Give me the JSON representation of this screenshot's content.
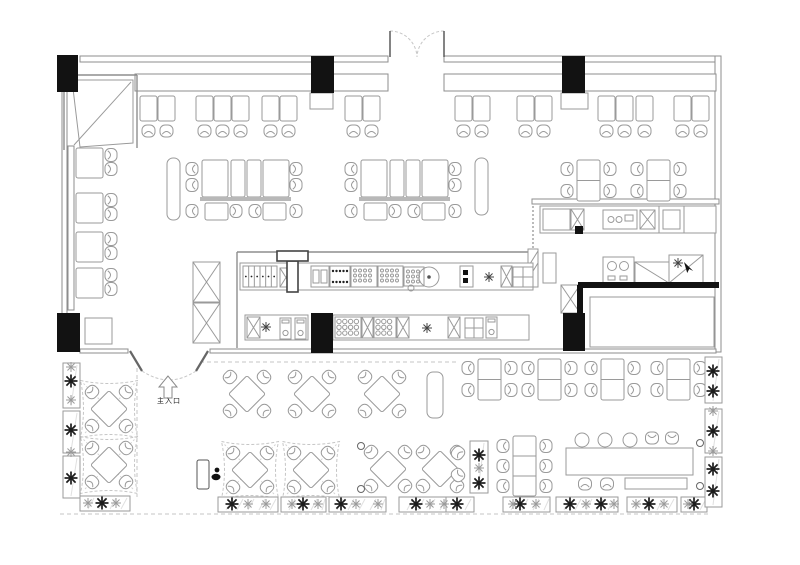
{
  "labels": {
    "entrance": "主入口"
  },
  "colors": {
    "bg": "#ffffff",
    "line": "#9a9a9a",
    "line_dark": "#5a5a5a",
    "black": "#121212",
    "light": "#c6c6c6",
    "bar": "#b8b8b8",
    "plant_dark": "#1c1c1c",
    "plant_light": "#9b9b9b"
  },
  "plan": {
    "columns": [
      [
        57,
        55,
        21,
        37
      ],
      [
        311,
        56,
        23,
        37
      ],
      [
        562,
        56,
        23,
        37
      ],
      [
        57,
        313,
        23,
        39
      ],
      [
        311,
        313,
        22,
        40
      ],
      [
        563,
        313,
        22,
        38
      ]
    ],
    "walls": {
      "rects": [
        [
          80,
          56,
          308,
          6
        ],
        [
          444,
          56,
          272,
          6
        ],
        [
          715,
          56,
          6,
          296
        ],
        [
          62,
          90,
          5,
          225
        ],
        [
          80,
          349,
          48,
          4
        ],
        [
          210,
          349,
          506,
          4
        ],
        [
          532,
          199,
          187,
          5
        ],
        [
          135,
          74,
          253,
          17
        ],
        [
          444,
          74,
          272,
          17
        ],
        [
          68,
          146,
          6,
          164
        ]
      ],
      "lines": [
        [
          237,
          252,
          533,
          252
        ],
        [
          237,
          252,
          237,
          348
        ],
        [
          64,
          150,
          64,
          75
        ],
        [
          64,
          75,
          137,
          75
        ],
        [
          137,
          75,
          137,
          148
        ]
      ],
      "thick": [
        [
          578,
          285,
          719,
          285
        ],
        [
          580,
          285,
          580,
          351
        ]
      ],
      "inner_room": [
        590,
        297,
        124,
        50
      ],
      "booth_poly": "72,80 133,80 133,143 80,147",
      "booth_diag": [
        74,
        145,
        131,
        82
      ],
      "post": [
        528,
        249,
        10,
        38
      ],
      "squiggle": [
        533,
        206,
        533,
        249
      ]
    },
    "dashed_lines": [
      [
        200,
        362,
        456,
        362
      ],
      [
        137,
        368,
        137,
        497
      ],
      [
        60,
        514,
        708,
        514
      ]
    ],
    "doors": {
      "top_arcs": [
        "M390,31 A27,27 0 0 1 417,57",
        "M444,31 A27,27 0 0 0 417,57"
      ],
      "top_leaves": [
        [
          390,
          31,
          390,
          57
        ],
        [
          444,
          31,
          444,
          57
        ]
      ],
      "ent_arcs": [
        "M142,371 Q156,380 169,380",
        "M196,371 Q182,380 169,380"
      ],
      "ent_leaves": [
        [
          130,
          351,
          142,
          371
        ],
        [
          208,
          351,
          196,
          371
        ]
      ],
      "arrow": "168,376 159,387 164,387 164,398 172,398 172,387 177,387"
    },
    "top_tables": [
      140,
      158,
      196,
      214,
      232,
      262,
      280,
      345,
      363,
      455,
      473,
      517,
      535,
      598,
      616,
      636,
      674,
      692
    ],
    "service_tables": [
      [
        310,
        93,
        23,
        16
      ],
      [
        561,
        93,
        27,
        16
      ]
    ],
    "wall_tables_y": [
      148,
      193,
      232,
      268
    ],
    "square_tables": [
      [
        85,
        318,
        27,
        26
      ]
    ],
    "clusters": [
      [
        202,
        160
      ],
      [
        361,
        160
      ]
    ],
    "benches": [
      [
        167,
        158,
        13,
        62
      ],
      [
        475,
        158,
        13,
        57
      ],
      [
        427,
        372,
        16,
        46
      ]
    ],
    "four_seat": [
      [
        577,
        160
      ],
      [
        647,
        160
      ],
      [
        478,
        359
      ],
      [
        538,
        359
      ],
      [
        601,
        359
      ],
      [
        667,
        359
      ]
    ],
    "six_seat": [
      [
        513,
        436
      ]
    ],
    "diamonds": [
      [
        247,
        394
      ],
      [
        312,
        394
      ],
      [
        382,
        394
      ],
      [
        388,
        469
      ],
      [
        440,
        469
      ]
    ],
    "canopies": [
      [
        109,
        409
      ],
      [
        109,
        465
      ],
      [
        250,
        470
      ],
      [
        311,
        470
      ]
    ],
    "long_table": {
      "table": [
        566,
        448,
        127,
        27
      ],
      "stools": [
        [
          582,
          440
        ],
        [
          605,
          440
        ],
        [
          630,
          440
        ]
      ],
      "chairs": [
        [
          652,
          438
        ],
        [
          672,
          438
        ]
      ],
      "stools2": [
        [
          578,
          477
        ],
        [
          600,
          477
        ]
      ],
      "bench": [
        625,
        478,
        62,
        11
      ]
    },
    "corner_chairs": [
      [
        458,
        453,
        -50
      ],
      [
        458,
        475,
        -130
      ]
    ],
    "lights": [
      [
        361,
        446
      ],
      [
        361,
        489
      ],
      [
        700,
        443
      ],
      [
        700,
        486
      ]
    ],
    "sign": [
      197,
      460,
      12,
      29
    ],
    "person": [
      216,
      470
    ],
    "cursor": [
      684,
      262
    ],
    "tduct": [
      277,
      251,
      31,
      41
    ],
    "kitchen": [
      [
        "plain",
        240,
        263,
        293,
        27
      ],
      [
        "compartments",
        243,
        266,
        34,
        21
      ],
      [
        "xbox",
        280,
        268,
        12,
        19
      ],
      [
        "sink2",
        311,
        266,
        18,
        21
      ],
      [
        "burners",
        330,
        266,
        20,
        21
      ],
      [
        "circgrid",
        351,
        266,
        26,
        21
      ],
      [
        "circgrid",
        378,
        266,
        25,
        21
      ],
      [
        "circgrid",
        404,
        267,
        20,
        19
      ],
      [
        "circ",
        411,
        288,
        3,
        0
      ],
      [
        "bigcirc",
        429,
        277,
        10,
        0
      ],
      [
        "blackpair",
        460,
        266,
        13,
        21
      ],
      [
        "drain",
        489,
        277,
        0,
        0
      ],
      [
        "xbox",
        501,
        266,
        11,
        21
      ],
      [
        "grid2x2",
        513,
        267,
        20,
        20
      ],
      [
        "plain",
        245,
        315,
        63,
        25
      ],
      [
        "xbox",
        247,
        317,
        13,
        21
      ],
      [
        "drain",
        266,
        327,
        0,
        0
      ],
      [
        "bottle",
        280,
        318,
        11,
        21
      ],
      [
        "bottle",
        295,
        318,
        11,
        21
      ],
      [
        "plain",
        333,
        315,
        196,
        25
      ],
      [
        "griddle",
        335,
        317,
        26,
        21
      ],
      [
        "xbox",
        362,
        317,
        11,
        21
      ],
      [
        "griddle",
        374,
        317,
        22,
        21
      ],
      [
        "xbox",
        397,
        317,
        12,
        21
      ],
      [
        "drain",
        427,
        328,
        0,
        0
      ],
      [
        "xbox",
        448,
        317,
        12,
        21
      ],
      [
        "grid2x2",
        465,
        318,
        18,
        20
      ],
      [
        "bottle",
        486,
        317,
        11,
        21
      ],
      [
        "plain",
        540,
        206,
        176,
        27
      ],
      [
        "plain",
        543,
        209,
        27,
        21
      ],
      [
        "xbox",
        571,
        209,
        13,
        21
      ],
      [
        "blacksq",
        575,
        226,
        8,
        8
      ],
      [
        "sinkoval",
        603,
        210,
        34,
        19
      ],
      [
        "xbox",
        640,
        210,
        15,
        19
      ],
      [
        "hood",
        659,
        206,
        25,
        27
      ],
      [
        "plain",
        543,
        253,
        13,
        30
      ],
      [
        "xbox",
        561,
        285,
        19,
        28
      ],
      [
        "sinkfaucet",
        603,
        257,
        31,
        26
      ],
      [
        "diag",
        635,
        262,
        34,
        21
      ],
      [
        "asterdiag",
        669,
        255,
        34,
        28
      ],
      [
        "xbox",
        193,
        262,
        27,
        40
      ],
      [
        "xbox",
        193,
        303,
        27,
        40
      ]
    ],
    "planters": [
      [
        63,
        363,
        17,
        45
      ],
      [
        63,
        411,
        17,
        42
      ],
      [
        63,
        456,
        17,
        42
      ],
      [
        80,
        496,
        50,
        15
      ],
      [
        218,
        497,
        60,
        15
      ],
      [
        281,
        497,
        45,
        15
      ],
      [
        329,
        497,
        57,
        15
      ],
      [
        399,
        497,
        64,
        15
      ],
      [
        446,
        497,
        28,
        15
      ],
      [
        503,
        497,
        47,
        15
      ],
      [
        556,
        497,
        62,
        15
      ],
      [
        627,
        497,
        50,
        15
      ],
      [
        681,
        497,
        26,
        15
      ],
      [
        705,
        357,
        17,
        46
      ],
      [
        705,
        409,
        17,
        44
      ],
      [
        705,
        457,
        17,
        50
      ],
      [
        470,
        441,
        18,
        52
      ]
    ],
    "plants_dark": [
      [
        71,
        381
      ],
      [
        71,
        430
      ],
      [
        71,
        478
      ],
      [
        102,
        503
      ],
      [
        232,
        504
      ],
      [
        303,
        504
      ],
      [
        341,
        504
      ],
      [
        416,
        504
      ],
      [
        457,
        504
      ],
      [
        520,
        504
      ],
      [
        570,
        504
      ],
      [
        601,
        504
      ],
      [
        649,
        504
      ],
      [
        694,
        504
      ],
      [
        713,
        371
      ],
      [
        713,
        391
      ],
      [
        713,
        431
      ],
      [
        713,
        469
      ],
      [
        713,
        491
      ],
      [
        479,
        455
      ],
      [
        479,
        483
      ]
    ],
    "plants_light": [
      [
        71,
        367
      ],
      [
        71,
        400
      ],
      [
        71,
        452
      ],
      [
        88,
        503
      ],
      [
        116,
        503
      ],
      [
        248,
        504
      ],
      [
        266,
        504
      ],
      [
        292,
        504
      ],
      [
        318,
        504
      ],
      [
        356,
        504
      ],
      [
        378,
        504
      ],
      [
        430,
        504
      ],
      [
        444,
        504
      ],
      [
        513,
        504
      ],
      [
        536,
        504
      ],
      [
        586,
        504
      ],
      [
        614,
        504
      ],
      [
        636,
        504
      ],
      [
        664,
        504
      ],
      [
        688,
        504
      ],
      [
        713,
        411
      ],
      [
        713,
        451
      ],
      [
        479,
        468
      ]
    ]
  }
}
